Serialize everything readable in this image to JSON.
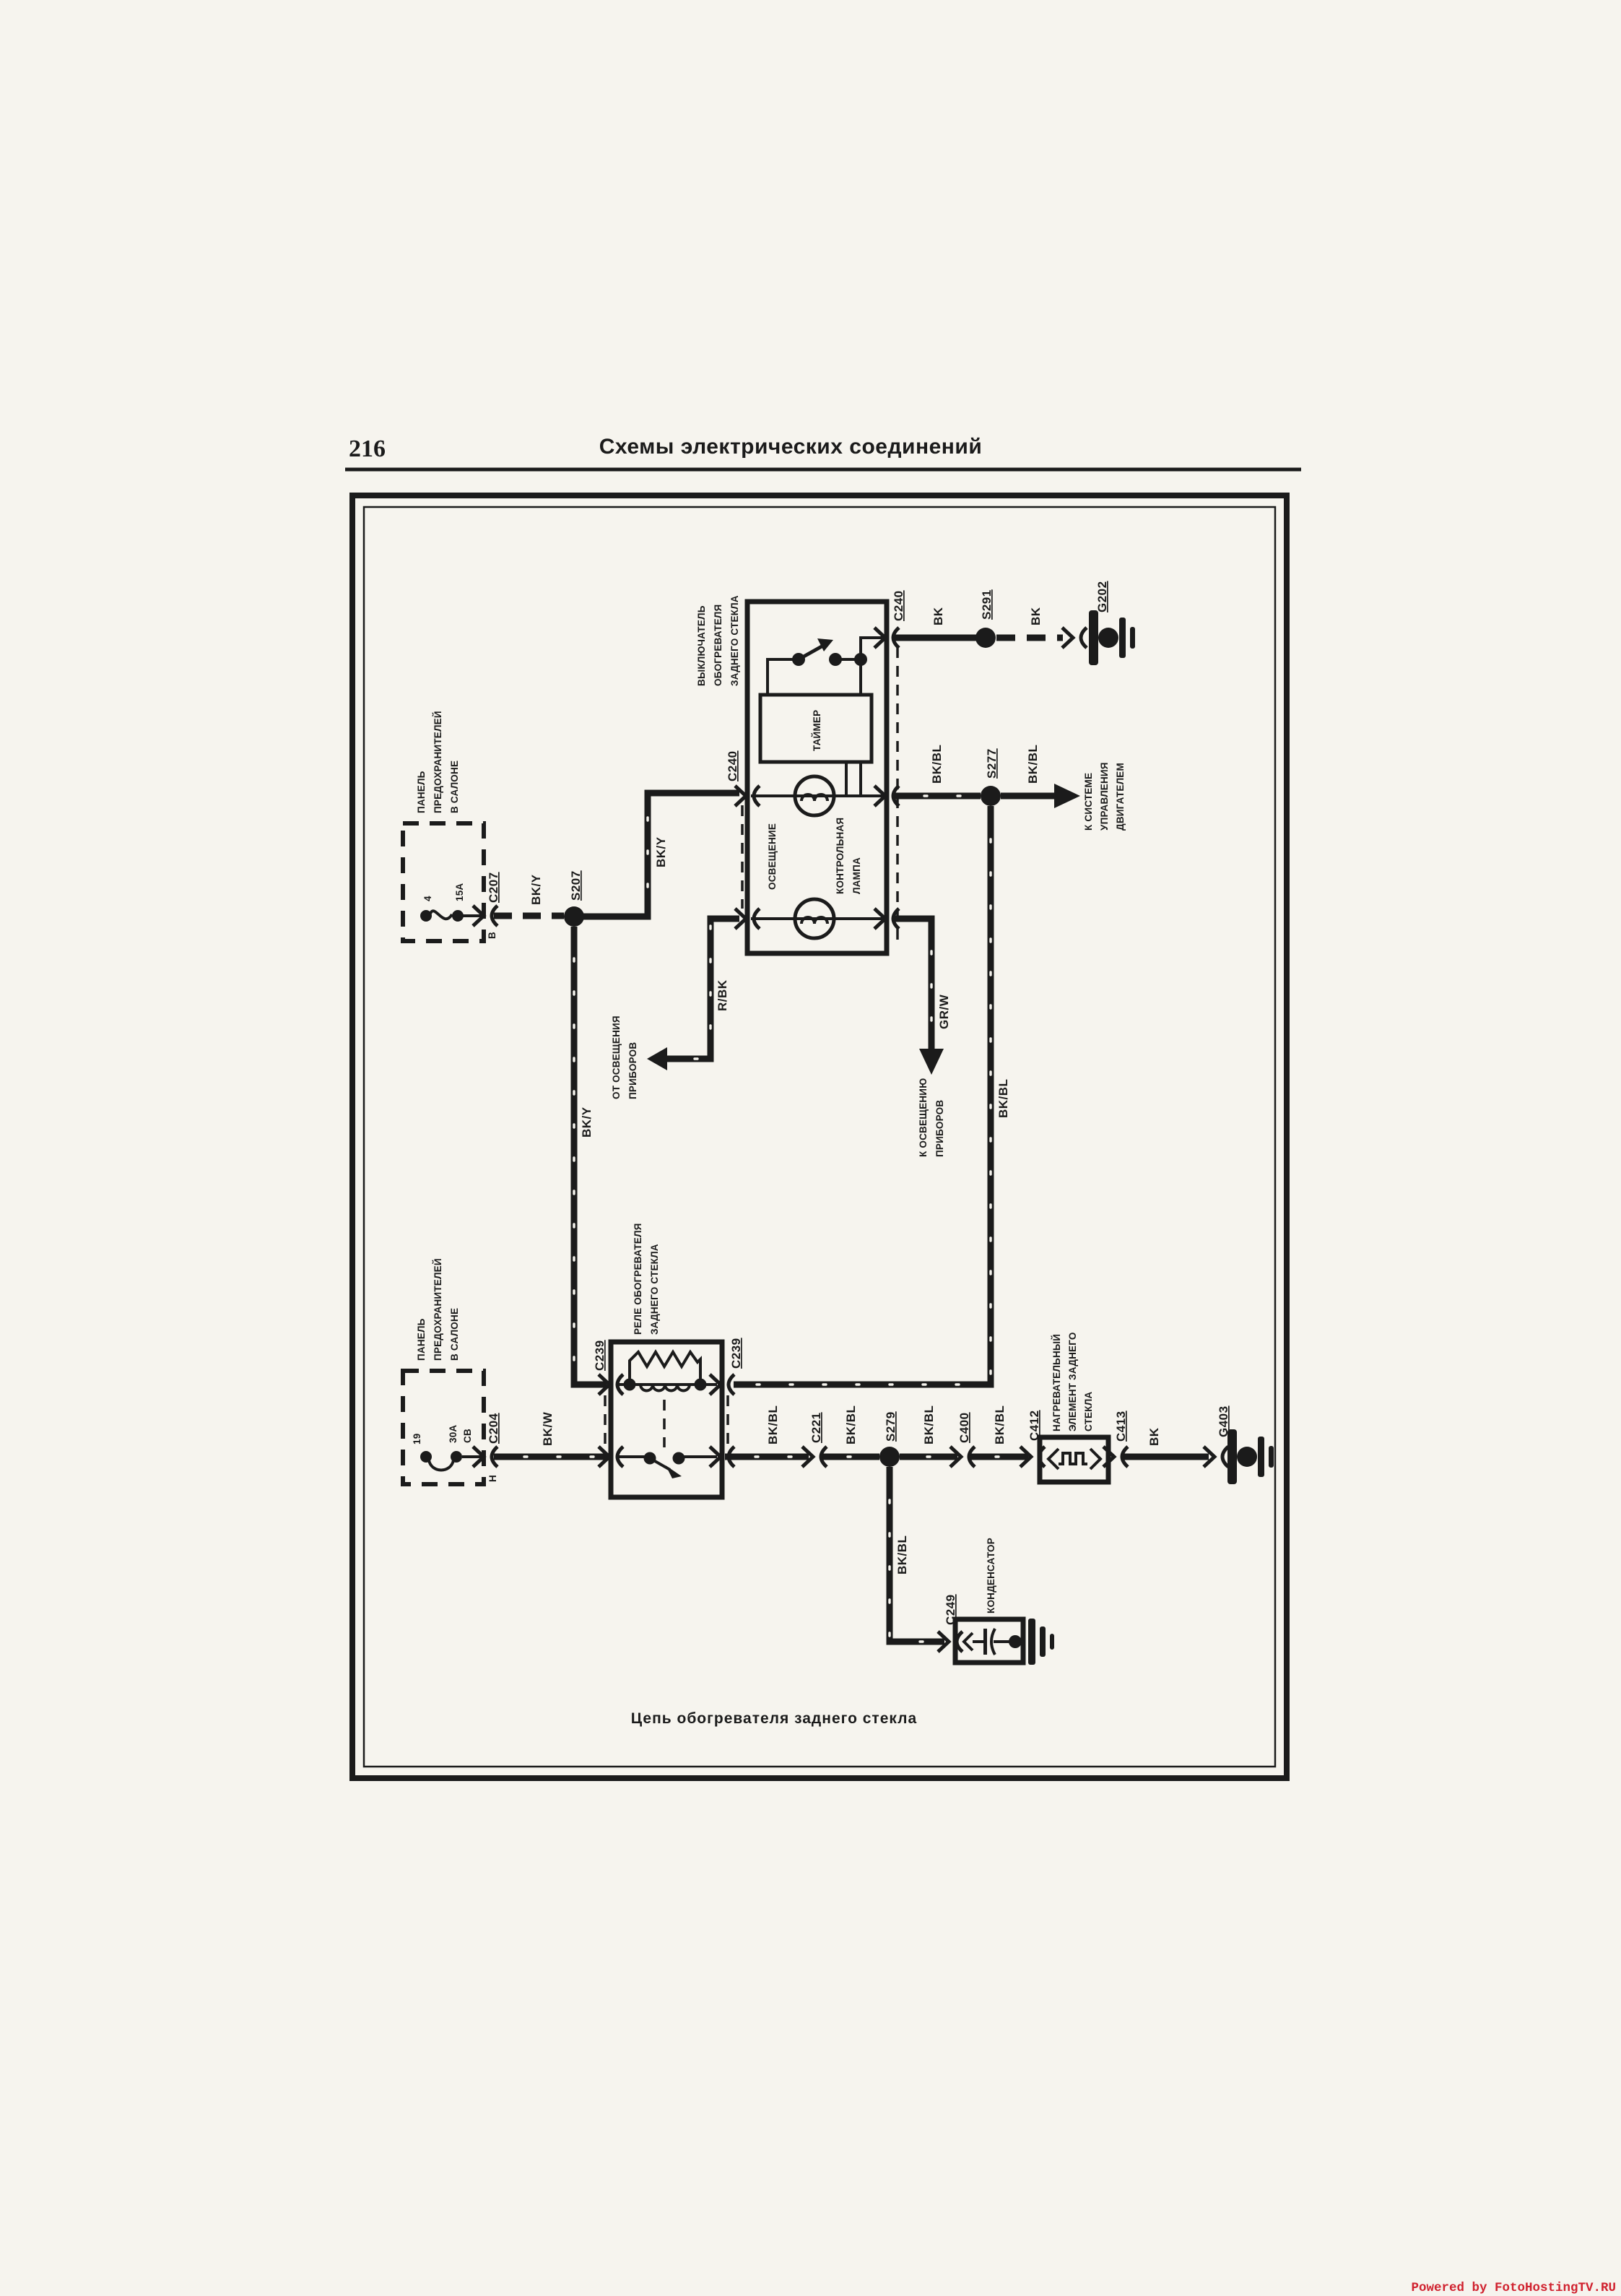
{
  "page": {
    "number": "216",
    "title": "Схемы электрических соединений",
    "caption": "Цепь обогревателя заднего стекла",
    "watermark": "Powered by FotoHostingTV.RU"
  },
  "colors": {
    "ink": "#1b1b1b",
    "paper": "#f6f4ee",
    "watermark": "#d0222f"
  },
  "labels": {
    "fuse_panel_interior": [
      "ПАНЕЛЬ",
      "ПРЕДОХРАНИТЕЛЕЙ",
      "В САЛОНЕ"
    ],
    "fuse": {
      "position": "4",
      "rating": "15A",
      "connector": "C207",
      "pin": "B",
      "splice": "S207"
    },
    "breaker": {
      "position": "19",
      "rating_amps": "30A",
      "rating_type": "CB",
      "connector": "C204",
      "pin": "H"
    },
    "defogger_switch": {
      "name_1": "ВЫКЛЮЧАТЕЛЬ",
      "name_2": "ОБОГРЕВАТЕЛЯ",
      "name_3": "ЗАДНЕГО СТЕКЛА",
      "timer": "ТАЙМЕР",
      "lamp_illumination": "ОСВЕЩЕНИЕ",
      "lamp_indicator_1": "КОНТРОЛЬНАЯ",
      "lamp_indicator_2": "ЛАМПА",
      "connector_top": "C240",
      "connector_left": "C240"
    },
    "relay": {
      "name_1": "РЕЛЕ ОБОГРЕВАТЕЛЯ",
      "name_2": "ЗАДНЕГО СТЕКЛА",
      "connector": "C239"
    },
    "heater": {
      "name_1": "НАГРЕВАТЕЛЬНЫЙ",
      "name_2": "ЭЛЕМЕНТ ЗАДНЕГО",
      "name_3": "СТЕКЛА"
    },
    "capacitor": {
      "name": "КОНДЕНСАТОР",
      "connector": "C249"
    },
    "splices": {
      "s277": "S277",
      "s279": "S279",
      "s291": "S291"
    },
    "grounds": {
      "g202": "G202",
      "g403": "G403"
    },
    "connectors": {
      "c221": "C221",
      "c400": "C400",
      "c412": "C412",
      "c413": "C413"
    },
    "wires": {
      "bk": "BK",
      "bk_y": "BK/Y",
      "bk_w": "BK/W",
      "bk_bl": "BK/BL",
      "r_bk": "R/BK",
      "gr_w": "GR/W"
    },
    "offpage": {
      "from_instruments_1": "ОТ ОСВЕЩЕНИЯ",
      "from_instruments_2": "ПРИБОРОВ",
      "to_instruments_1": "К ОСВЕЩЕНИЮ",
      "to_instruments_2": "ПРИБОРОВ",
      "to_ecm_1": "К СИСТЕМЕ",
      "to_ecm_2": "УПРАВЛЕНИЯ",
      "to_ecm_3": "ДВИГАТЕЛЕМ"
    }
  }
}
